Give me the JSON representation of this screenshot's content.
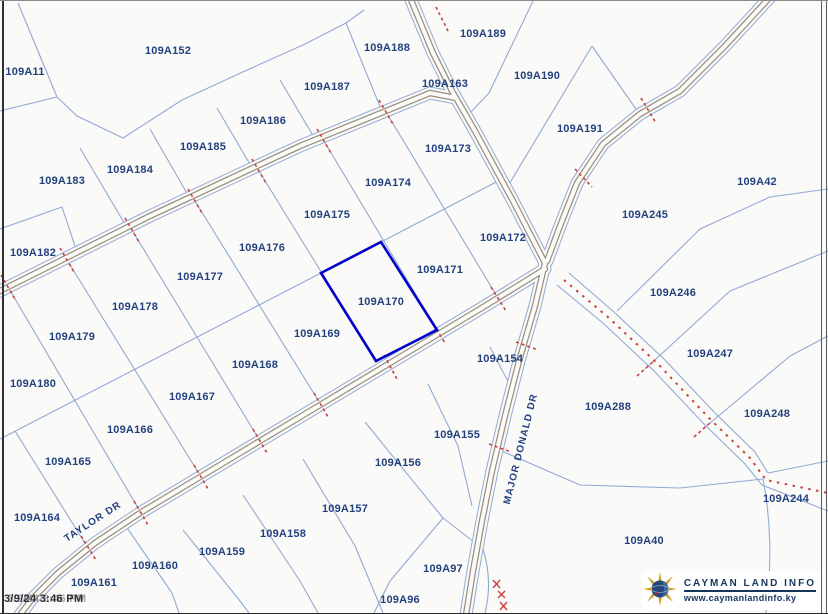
{
  "map": {
    "timestamp": "3/9/24 3:46 PM",
    "selected_parcel": "109A170",
    "roads": [
      {
        "name": "TAYLOR DR"
      },
      {
        "name": "MAJOR DONALD DR"
      }
    ],
    "parcels": [
      {
        "id": "109A11",
        "x": 25,
        "y": 71
      },
      {
        "id": "109A152",
        "x": 168,
        "y": 50
      },
      {
        "id": "109A188",
        "x": 387,
        "y": 47
      },
      {
        "id": "109A189",
        "x": 483,
        "y": 33
      },
      {
        "id": "109A163",
        "x": 445,
        "y": 83
      },
      {
        "id": "109A190",
        "x": 537,
        "y": 75
      },
      {
        "id": "109A187",
        "x": 327,
        "y": 86
      },
      {
        "id": "109A186",
        "x": 263,
        "y": 120
      },
      {
        "id": "109A185",
        "x": 203,
        "y": 146
      },
      {
        "id": "109A184",
        "x": 130,
        "y": 169
      },
      {
        "id": "109A183",
        "x": 62,
        "y": 180
      },
      {
        "id": "109A191",
        "x": 580,
        "y": 128
      },
      {
        "id": "109A42",
        "x": 757,
        "y": 181
      },
      {
        "id": "109A245",
        "x": 645,
        "y": 214
      },
      {
        "id": "109A173",
        "x": 448,
        "y": 148
      },
      {
        "id": "109A174",
        "x": 388,
        "y": 182
      },
      {
        "id": "109A175",
        "x": 327,
        "y": 214
      },
      {
        "id": "109A176",
        "x": 262,
        "y": 247
      },
      {
        "id": "109A177",
        "x": 200,
        "y": 276
      },
      {
        "id": "109A178",
        "x": 135,
        "y": 306
      },
      {
        "id": "109A179",
        "x": 72,
        "y": 336
      },
      {
        "id": "109A182",
        "x": 33,
        "y": 252
      },
      {
        "id": "109A180",
        "x": 33,
        "y": 383
      },
      {
        "id": "109A172",
        "x": 503,
        "y": 237
      },
      {
        "id": "109A171",
        "x": 440,
        "y": 269
      },
      {
        "id": "109A170",
        "x": 381,
        "y": 301
      },
      {
        "id": "109A169",
        "x": 317,
        "y": 333
      },
      {
        "id": "109A168",
        "x": 255,
        "y": 364
      },
      {
        "id": "109A167",
        "x": 192,
        "y": 396
      },
      {
        "id": "109A166",
        "x": 130,
        "y": 429
      },
      {
        "id": "109A165",
        "x": 68,
        "y": 461
      },
      {
        "id": "109A164",
        "x": 37,
        "y": 517
      },
      {
        "id": "109A154",
        "x": 500,
        "y": 358
      },
      {
        "id": "109A155",
        "x": 457,
        "y": 434
      },
      {
        "id": "109A156",
        "x": 398,
        "y": 462
      },
      {
        "id": "109A157",
        "x": 345,
        "y": 508
      },
      {
        "id": "109A158",
        "x": 283,
        "y": 533
      },
      {
        "id": "109A159",
        "x": 222,
        "y": 551
      },
      {
        "id": "109A160",
        "x": 155,
        "y": 565
      },
      {
        "id": "109A161",
        "x": 94,
        "y": 582
      },
      {
        "id": "109A96",
        "x": 400,
        "y": 599
      },
      {
        "id": "109A97",
        "x": 443,
        "y": 568
      },
      {
        "id": "109A246",
        "x": 673,
        "y": 292
      },
      {
        "id": "109A247",
        "x": 710,
        "y": 353
      },
      {
        "id": "109A248",
        "x": 767,
        "y": 413
      },
      {
        "id": "109A288",
        "x": 608,
        "y": 406
      },
      {
        "id": "109A244",
        "x": 786,
        "y": 498
      },
      {
        "id": "109A40",
        "x": 644,
        "y": 540
      }
    ],
    "colors": {
      "boundary_line": "#93a9d4",
      "label_text": "#24417f",
      "selected_outline": "#0101c9",
      "survey_marks": "#c94040",
      "road_casing": "#99907f"
    }
  },
  "branding": {
    "org": "CAYMAN LAND INFO",
    "website": "www.caymanlandinfo.ky"
  }
}
